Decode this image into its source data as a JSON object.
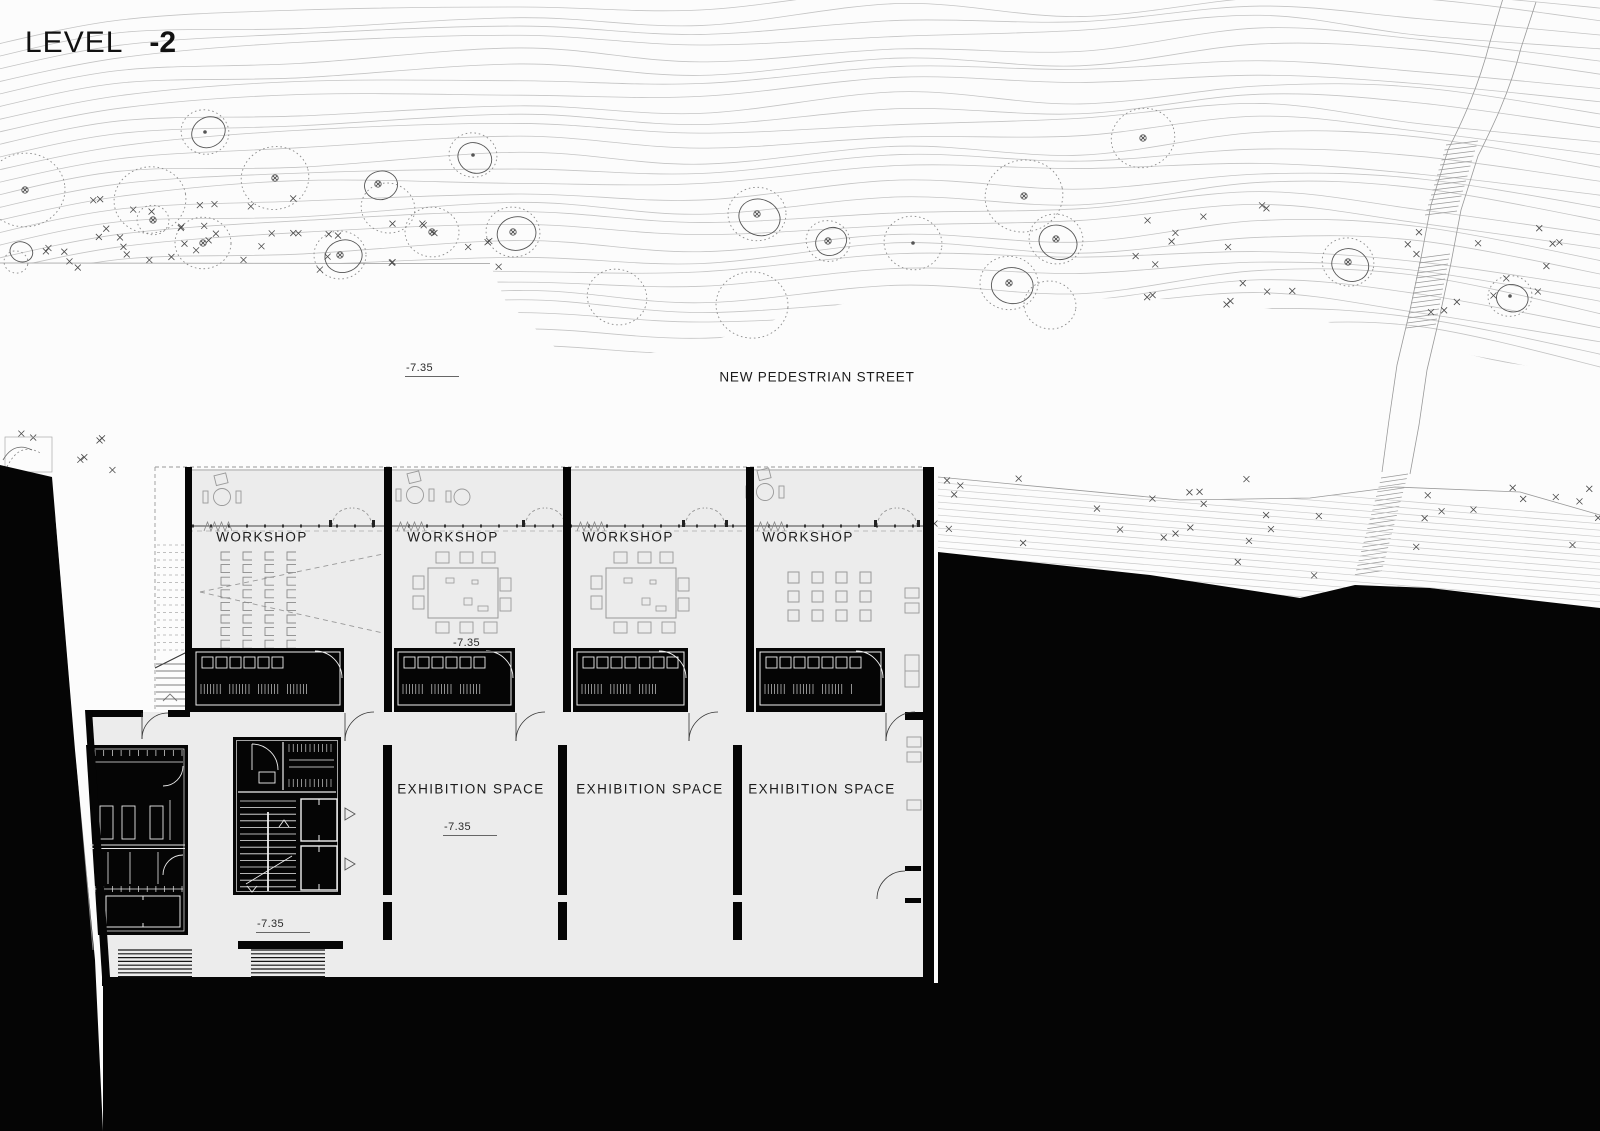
{
  "title": {
    "word": "LEVEL",
    "number": "-2"
  },
  "site": {
    "street_label": "NEW PEDESTRIAN STREET",
    "elevation_label": "-7.35",
    "trees": [
      {
        "x": 25,
        "y": 190,
        "r": 40,
        "s": 0,
        "d": 1,
        "m": "x"
      },
      {
        "x": 150,
        "y": 200,
        "r": 36,
        "s": 0,
        "d": 1,
        "m": "none"
      },
      {
        "x": 153,
        "y": 220,
        "r": 16,
        "s": 0,
        "d": 1,
        "m": "x"
      },
      {
        "x": 205,
        "y": 132,
        "r": 24,
        "s": 1,
        "d": 1,
        "m": "dot"
      },
      {
        "x": 203,
        "y": 243,
        "r": 28,
        "s": 0,
        "d": 1,
        "m": "x"
      },
      {
        "x": 275,
        "y": 178,
        "r": 34,
        "s": 0,
        "d": 1,
        "m": "x"
      },
      {
        "x": 378,
        "y": 184,
        "r": 23,
        "s": 1,
        "d": 0,
        "m": "x"
      },
      {
        "x": 388,
        "y": 208,
        "r": 27,
        "s": 0,
        "d": 1,
        "m": "none"
      },
      {
        "x": 20,
        "y": 250,
        "r": 16,
        "s": 1,
        "d": 0,
        "m": "none"
      },
      {
        "x": 16,
        "y": 262,
        "r": 12,
        "s": 0,
        "d": 1,
        "m": "none"
      },
      {
        "x": 340,
        "y": 255,
        "r": 26,
        "s": 1,
        "d": 1,
        "m": "x"
      },
      {
        "x": 432,
        "y": 232,
        "r": 27,
        "s": 0,
        "d": 1,
        "m": "x"
      },
      {
        "x": 473,
        "y": 155,
        "r": 24,
        "s": 1,
        "d": 1,
        "m": "dot"
      },
      {
        "x": 513,
        "y": 232,
        "r": 27,
        "s": 1,
        "d": 1,
        "m": "x"
      },
      {
        "x": 617,
        "y": 297,
        "r": 30,
        "s": 0,
        "d": 1,
        "m": "none"
      },
      {
        "x": 752,
        "y": 305,
        "r": 36,
        "s": 0,
        "d": 1,
        "m": "none"
      },
      {
        "x": 757,
        "y": 214,
        "r": 29,
        "s": 1,
        "d": 1,
        "m": "x"
      },
      {
        "x": 828,
        "y": 241,
        "r": 22,
        "s": 1,
        "d": 1,
        "m": "x"
      },
      {
        "x": 913,
        "y": 243,
        "r": 29,
        "s": 0,
        "d": 1,
        "m": "dot"
      },
      {
        "x": 1024,
        "y": 196,
        "r": 39,
        "s": 0,
        "d": 1,
        "m": "x"
      },
      {
        "x": 1143,
        "y": 138,
        "r": 32,
        "s": 0,
        "d": 1,
        "m": "x"
      },
      {
        "x": 1056,
        "y": 239,
        "r": 27,
        "s": 1,
        "d": 1,
        "m": "x"
      },
      {
        "x": 1009,
        "y": 283,
        "r": 29,
        "s": 1,
        "d": 1,
        "m": "x"
      },
      {
        "x": 1050,
        "y": 305,
        "r": 26,
        "s": 0,
        "d": 1,
        "m": "none"
      },
      {
        "x": 1348,
        "y": 262,
        "r": 26,
        "s": 1,
        "d": 1,
        "m": "x"
      },
      {
        "x": 1510,
        "y": 296,
        "r": 22,
        "s": 1,
        "d": 1,
        "m": "dot"
      }
    ],
    "scrub_clusters": [
      [
        0,
        225,
        340,
        45,
        26
      ],
      [
        60,
        195,
        260,
        35,
        10
      ],
      [
        390,
        220,
        110,
        50,
        10
      ],
      [
        1135,
        205,
        160,
        100,
        16
      ],
      [
        1390,
        225,
        175,
        90,
        14
      ],
      [
        930,
        478,
        400,
        100,
        26
      ],
      [
        1395,
        478,
        205,
        85,
        12
      ],
      [
        15,
        430,
        120,
        40,
        7
      ]
    ]
  },
  "building": {
    "elevation_label": "-7.35",
    "workshops": [
      {
        "label": "WORKSHOP"
      },
      {
        "label": "WORKSHOP"
      },
      {
        "label": "WORKSHOP"
      },
      {
        "label": "WORKSHOP"
      }
    ],
    "exhibition_spaces": [
      {
        "label": "EXHIBITION SPACE"
      },
      {
        "label": "EXHIBITION SPACE"
      },
      {
        "label": "EXHIBITION SPACE"
      }
    ]
  }
}
